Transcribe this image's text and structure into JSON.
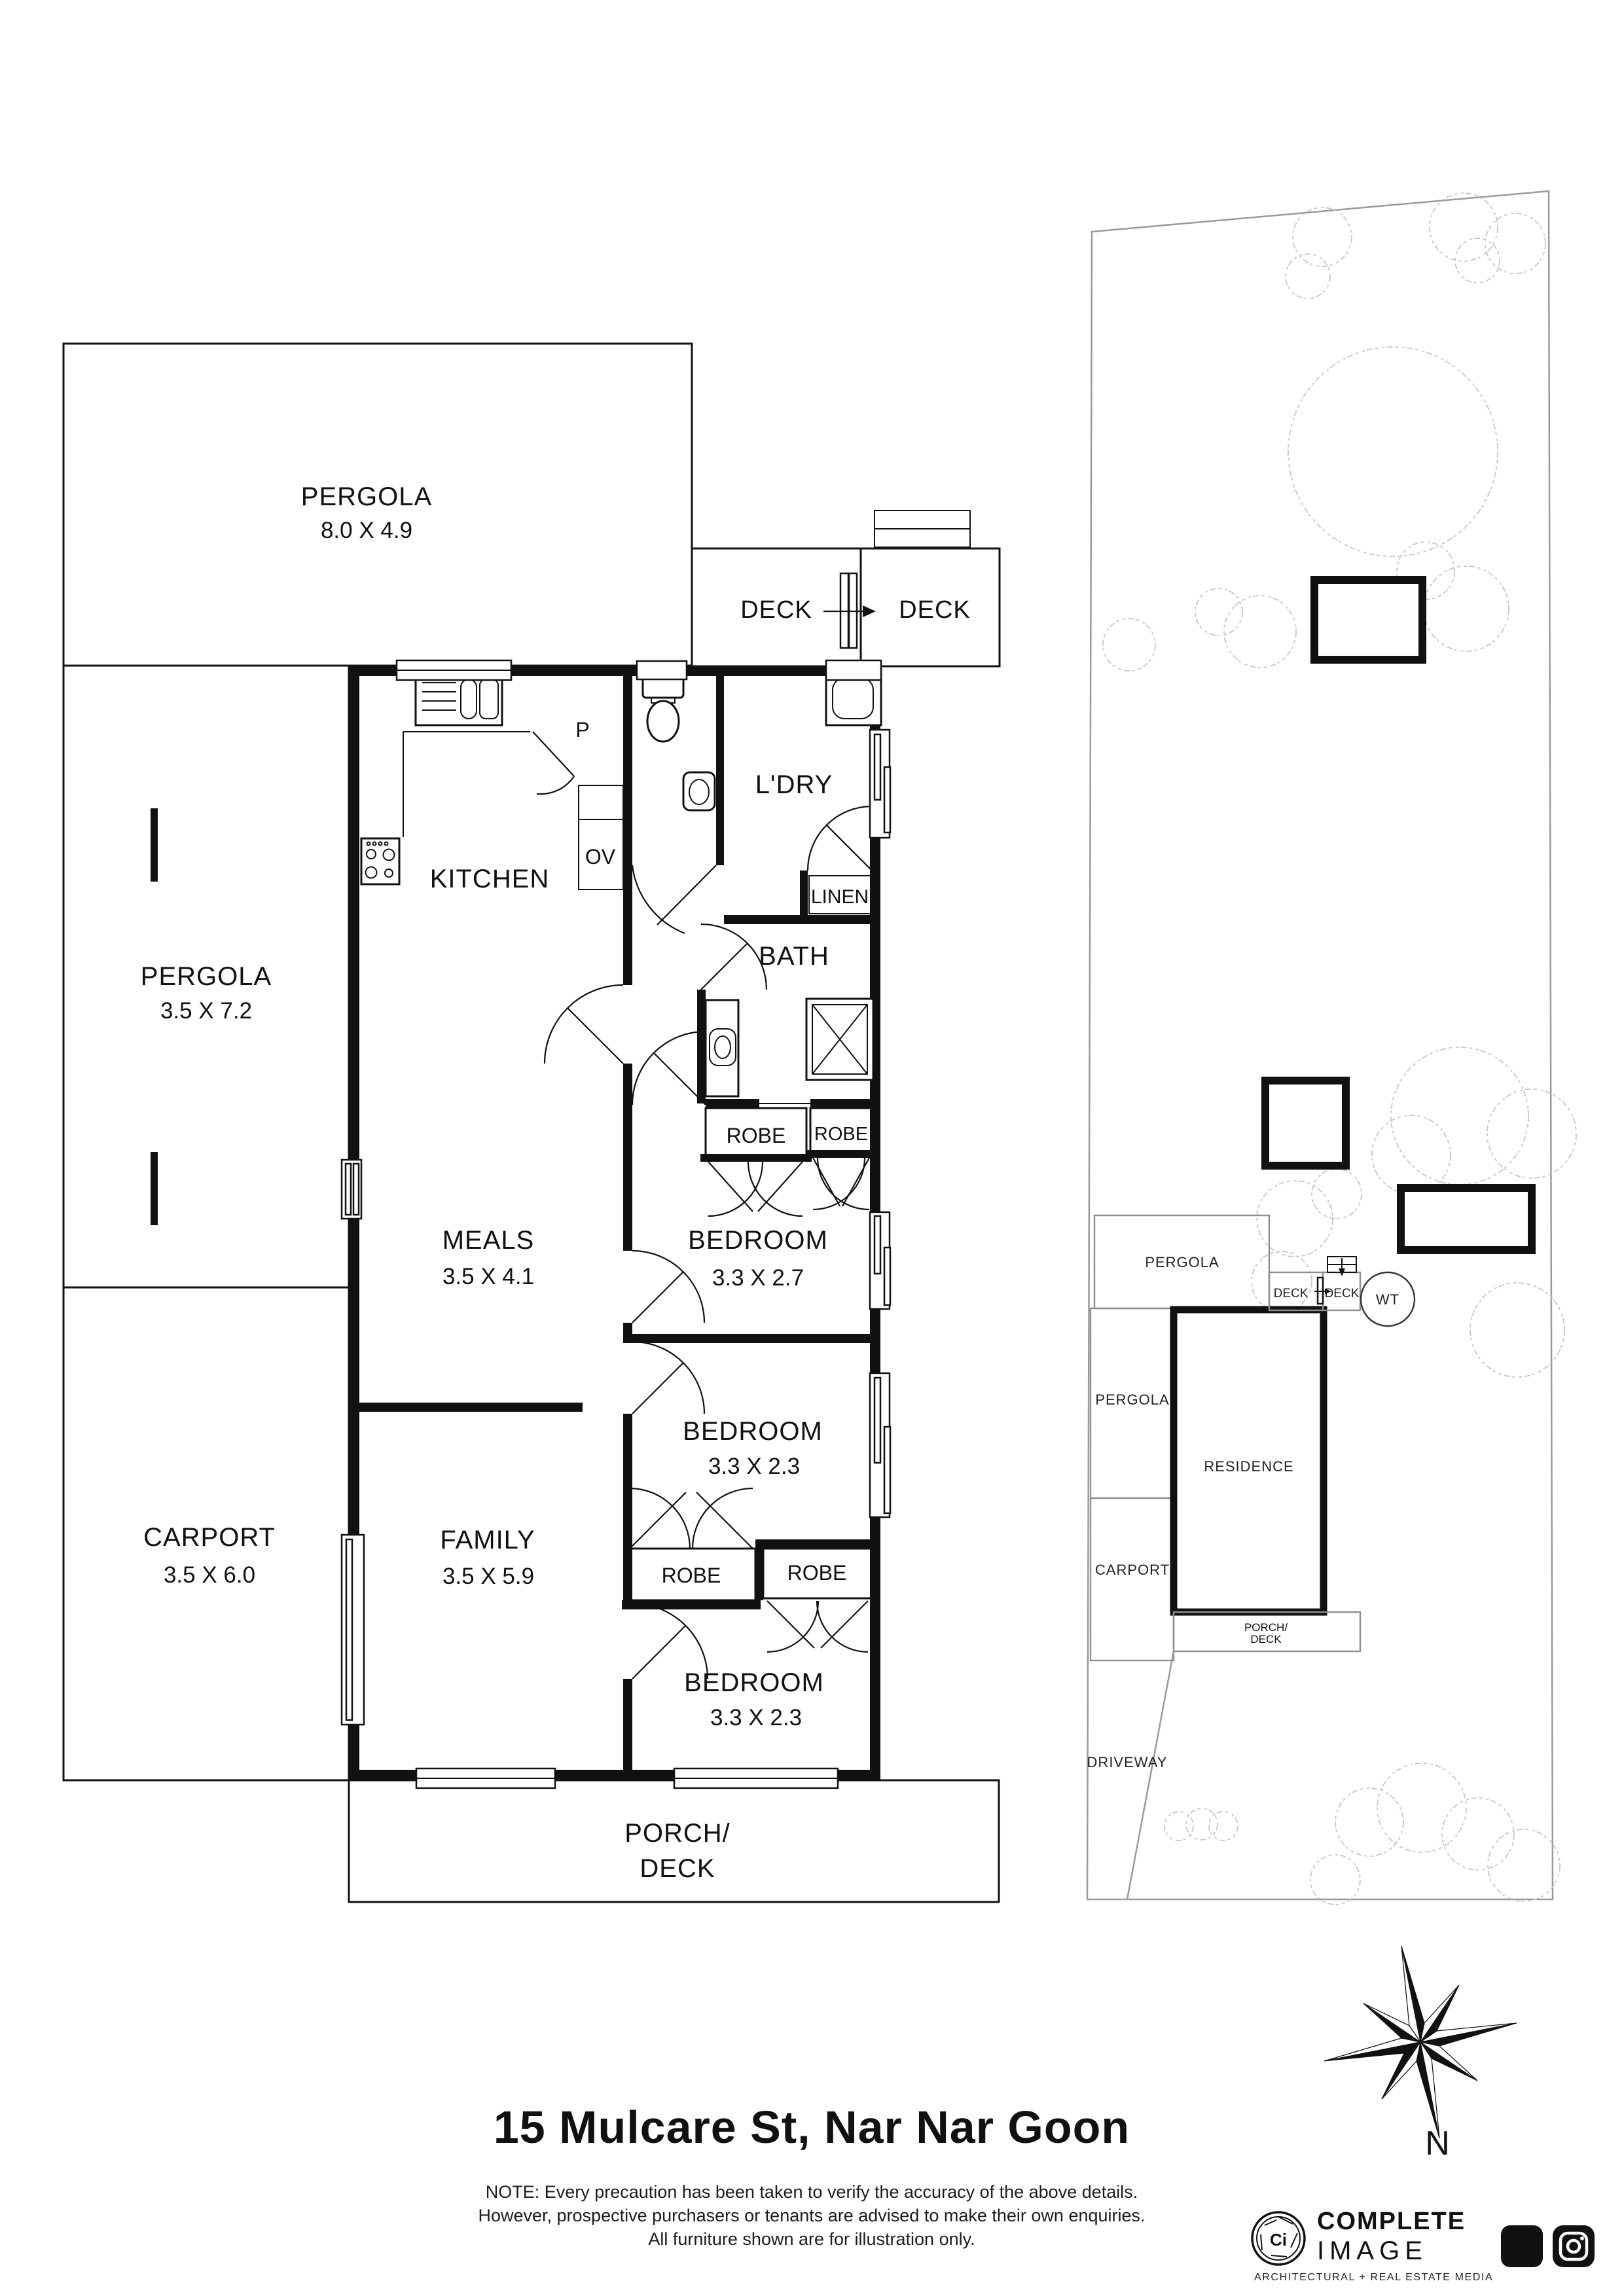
{
  "title": "15 Mulcare St, Nar Nar Goon",
  "floorplan": {
    "pergola_top": {
      "name": "PERGOLA",
      "dims": "8.0 X 4.9"
    },
    "deck_left": "DECK",
    "deck_right": "DECK",
    "pergola_left": {
      "name": "PERGOLA",
      "dims": "3.5 X 7.2"
    },
    "kitchen": "KITCHEN",
    "pantry": "P",
    "oven": "OV",
    "laundry": "L'DRY",
    "linen": "LINEN",
    "bath": "BATH",
    "robe_bed1_left": "ROBE",
    "robe_bed1_right": "ROBE",
    "meals": {
      "name": "MEALS",
      "dims": "3.5 X 4.1"
    },
    "bedroom1": {
      "name": "BEDROOM",
      "dims": "3.3 X 2.7"
    },
    "bedroom2": {
      "name": "BEDROOM",
      "dims": "3.3 X 2.3"
    },
    "carport": {
      "name": "CARPORT",
      "dims": "3.5 X 6.0"
    },
    "family": {
      "name": "FAMILY",
      "dims": "3.5 X 5.9"
    },
    "robe_bed2": "ROBE",
    "robe_bed3": "ROBE",
    "bedroom3": {
      "name": "BEDROOM",
      "dims": "3.3 X 2.3"
    },
    "porch": {
      "line1": "PORCH/",
      "line2": "DECK"
    }
  },
  "siteplan": {
    "pergola_top": "PERGOLA",
    "deck_left": "DECK",
    "deck_right": "DECK",
    "water_tank": "WT",
    "pergola": "PERGOLA",
    "residence": "RESIDENCE",
    "carport": "CARPORT",
    "porch_line1": "PORCH/",
    "porch_line2": "DECK",
    "driveway": "DRIVEWAY"
  },
  "compass": {
    "north": "N"
  },
  "disclaimer": {
    "line1": "NOTE: Every precaution has been taken to verify the accuracy of the above details.",
    "line2": "However, prospective purchasers or tenants are advised to make their own enquiries.",
    "line3": "All furniture shown are for illustration only."
  },
  "logo": {
    "monogram": "Ci",
    "brand_top": "COMPLETE",
    "brand_bottom": "IMAGE",
    "tagline": "ARCHITECTURAL + REAL ESTATE MEDIA"
  },
  "colors": {
    "ink": "#111111",
    "site_line": "#8f8f8f",
    "tree": "#c7c7c7"
  }
}
